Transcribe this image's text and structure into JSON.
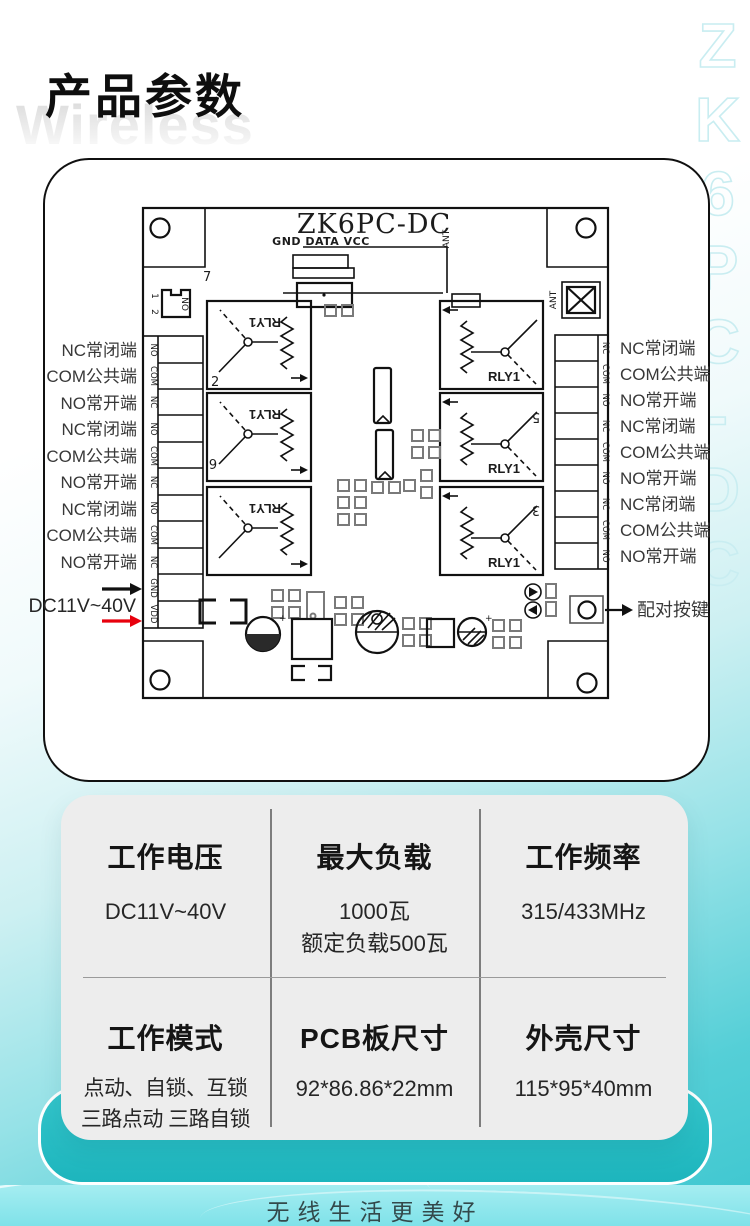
{
  "page": {
    "title": "产品参数",
    "watermark": "Wireless",
    "side_text": "ZK6PC-DC",
    "footer_slogan": "无线生活更美好"
  },
  "pcb": {
    "board_title": "ZK6PC-DC",
    "header_pins": "GND DATA VCC",
    "ant_label": "ANT",
    "relay_label": "RLY1",
    "chip_label": "NO",
    "numbers": {
      "above_relays": "7",
      "chip_pin_1": "1",
      "chip_pin_2": "2",
      "relay_left_1": "2",
      "relay_left_2": "6",
      "relay_right_2": "5",
      "relay_right_3": "3"
    },
    "left_terminals": [
      "NO",
      "COM",
      "NC",
      "NO",
      "COM",
      "NC",
      "NO",
      "COM",
      "NC",
      "GND",
      "VDD"
    ],
    "right_terminals": [
      "NC",
      "COM",
      "NO",
      "NC",
      "COM",
      "NO",
      "NC",
      "COM",
      "NO"
    ],
    "left_labels": [
      "NC常闭端",
      "COM公共端",
      "NO常开端",
      "NC常闭端",
      "COM公共端",
      "NO常开端",
      "NC常闭端",
      "COM公共端",
      "NO常开端"
    ],
    "right_labels": [
      "NC常闭端",
      "COM公共端",
      "NO常开端",
      "NC常闭端",
      "COM公共端",
      "NO常开端",
      "NC常闭端",
      "COM公共端",
      "NO常开端"
    ],
    "power_label": "DC11V~40V",
    "pair_button_label": "配对按键"
  },
  "specs": {
    "cells": [
      {
        "title": "工作电压",
        "lines": [
          "DC11V~40V"
        ]
      },
      {
        "title": "最大负载",
        "lines": [
          "1000瓦",
          "额定负载500瓦"
        ]
      },
      {
        "title": "工作频率",
        "lines": [
          "315/433MHz"
        ]
      },
      {
        "title": "工作模式",
        "lines": [
          "点动、自锁、互锁",
          "三路点动 三路自锁"
        ]
      },
      {
        "title": "PCB板尺寸",
        "lines": [
          "92*86.86*22mm"
        ]
      },
      {
        "title": "外壳尺寸",
        "lines": [
          "115*95*40mm"
        ]
      }
    ]
  },
  "colors": {
    "accent_teal": "#2abfc5",
    "footer_band": "#8ae6ec",
    "arrow_red": "#e8000d"
  }
}
